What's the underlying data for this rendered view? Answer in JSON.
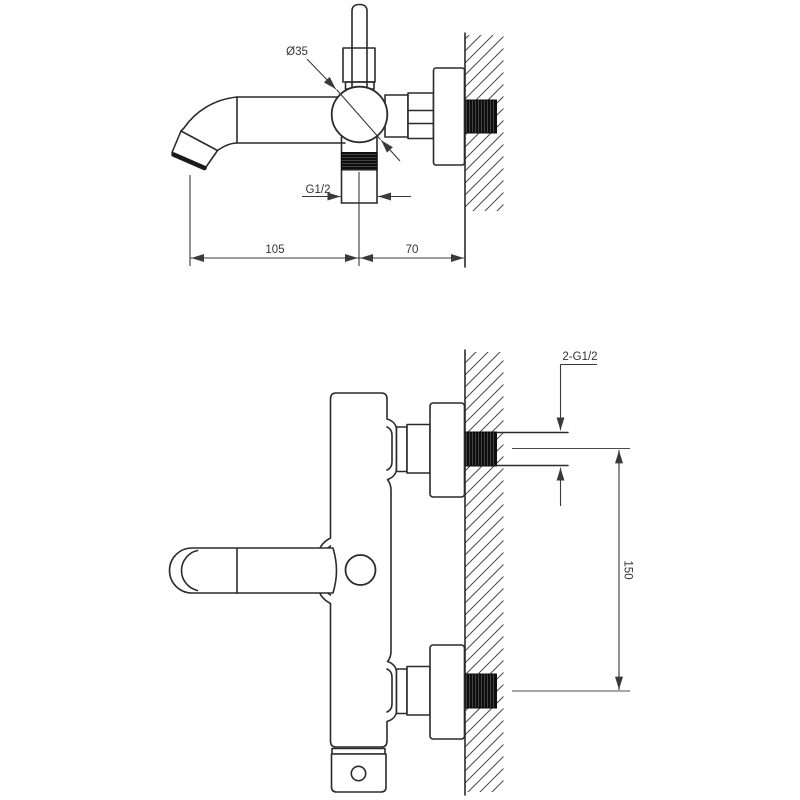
{
  "drawing": {
    "type": "technical-dimension-drawing",
    "subject": "wall-mounted bath mixer faucet, two orthographic views",
    "colors": {
      "background": "#ffffff",
      "outline": "#2b2b2b",
      "dimension_lines": "#3a3a3a",
      "thread_fill": "#0e0e0e",
      "grey_centerline": "#8a8a8a"
    },
    "side_view": {
      "labels": {
        "body_diameter": "Ø35",
        "outlet_thread": "G1/2",
        "spout_reach": "105",
        "body_depth": "70"
      }
    },
    "front_view": {
      "labels": {
        "inlet_threads": "2-G1/2",
        "inlet_spacing": "150"
      }
    }
  }
}
